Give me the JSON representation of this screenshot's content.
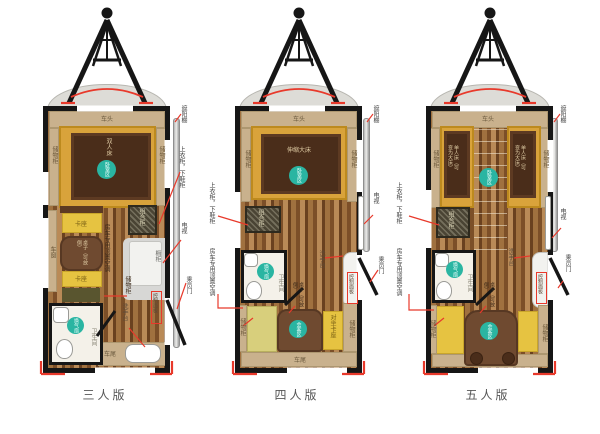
{
  "captions": [
    "三人版",
    "四人版",
    "五人版"
  ],
  "labels": {
    "awning": "遮阳棚",
    "tv": "电视",
    "door": "乘员门",
    "wardrobe": "上衣柜，下鞋柜",
    "ac": "房车专用顶置空调",
    "storage": "储物柜",
    "combo": "组合柜",
    "cupboard": "橱柜",
    "table_fold": "桌子（可放倒）",
    "booth": "卡座",
    "booth_facing": "对坐卡座",
    "bathroom": "卫生间",
    "fan": "换气扇",
    "zone_bedroom": "卧室区",
    "zone_guest": "会客区",
    "basin": "洗手台",
    "panel": "控制面板",
    "front": "车头",
    "rear": "车尾",
    "window": "车窗"
  },
  "beds": {
    "p1": "双人床",
    "p2": "伸缩大床",
    "p3": "单人床（可变为大床）"
  },
  "colors": {
    "accent_red": "#e8392b",
    "teal_zone": "#2ab5a2",
    "bed_platform_gold": "#d9a33b",
    "bed_dark_brown": "#4a2d1a",
    "wall_black": "#161616",
    "shelf_tan": "#c9b18d"
  }
}
